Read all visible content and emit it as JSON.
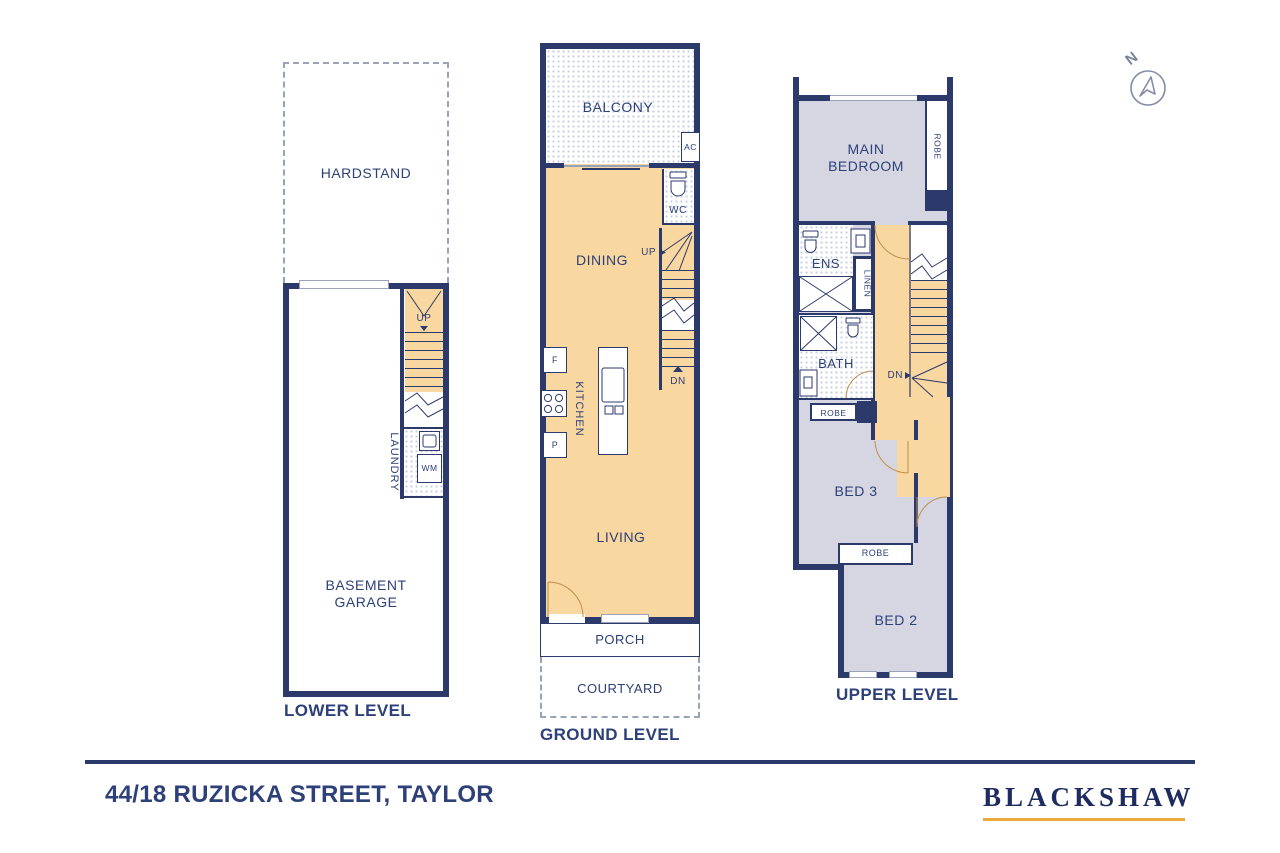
{
  "colors": {
    "wall_navy": "#2c3a6b",
    "label_navy": "#2d4078",
    "floor_orange": "#f9d7a0",
    "floor_lavender": "#d6d6e3",
    "hatch_dot": "#c7cede",
    "brand_gold": "#eba93e"
  },
  "compass": {
    "north": "N"
  },
  "lower": {
    "title": "LOWER LEVEL",
    "hardstand": "HARDSTAND",
    "up": "UP",
    "laundry": "LAUNDRY",
    "wm": "WM",
    "garage": "BASEMENT GARAGE"
  },
  "ground": {
    "title": "GROUND LEVEL",
    "balcony": "BALCONY",
    "ac": "AC",
    "wc": "WC",
    "dining": "DINING",
    "up": "UP",
    "dn": "DN",
    "fridge": "F",
    "kitchen": "KITCHEN",
    "pantry": "P",
    "living": "LIVING",
    "porch": "PORCH",
    "courtyard": "COURTYARD"
  },
  "upper": {
    "title": "UPPER LEVEL",
    "main_bedroom": "MAIN BEDROOM",
    "robe_main": "ROBE",
    "ens": "ENS",
    "linen": "LINEN",
    "bath": "BATH",
    "robe_hall": "ROBE",
    "dn": "DN",
    "bed3": "BED 3",
    "robe_bed": "ROBE",
    "bed2": "BED 2"
  },
  "footer": {
    "address": "44/18 RUZICKA STREET, TAYLOR",
    "brand": "BLACKSHAW"
  }
}
